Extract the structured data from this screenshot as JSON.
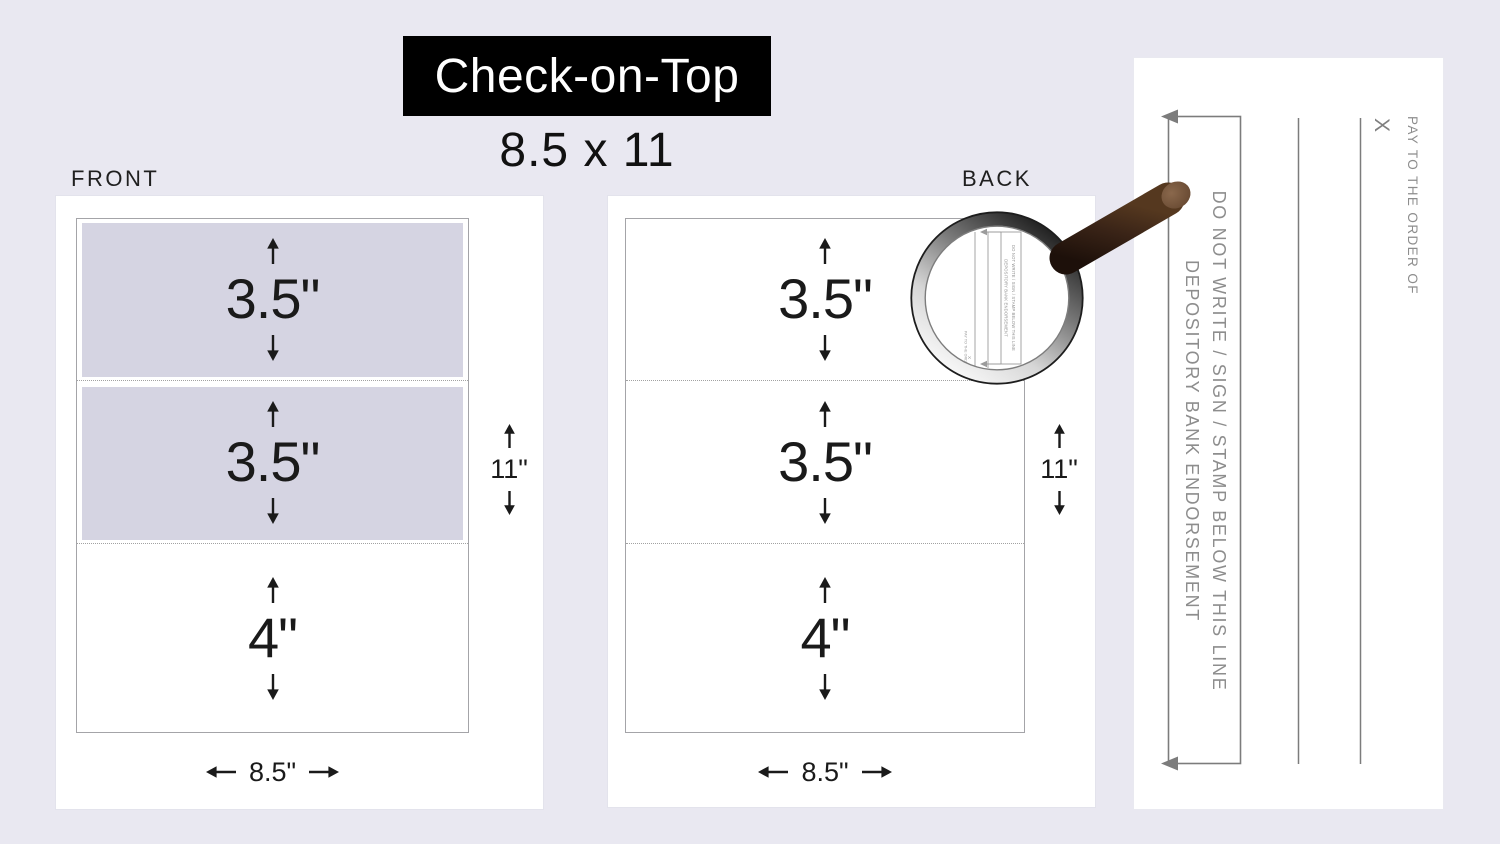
{
  "header": {
    "banner_title": "Check-on-Top",
    "sheet_size": "8.5 x 11"
  },
  "front_panel": {
    "label": "FRONT",
    "sections": [
      {
        "label": "3.5\"",
        "shaded": true
      },
      {
        "label": "3.5\"",
        "shaded": true
      },
      {
        "label": "4\"",
        "shaded": false
      }
    ],
    "height_label": "11\"",
    "width_label": "8.5\""
  },
  "back_panel": {
    "label": "BACK",
    "sections": [
      {
        "label": "3.5\"",
        "shaded": false
      },
      {
        "label": "3.5\"",
        "shaded": false
      },
      {
        "label": "4\"",
        "shaded": false
      }
    ],
    "height_label": "11\"",
    "width_label": "8.5\""
  },
  "endorsement_detail": {
    "warning_line1": "DO NOT WRITE / SIGN / STAMP BELOW THIS LINE",
    "warning_line2": "DEPOSITORY BANK ENDORSEMENT",
    "sign_x": "X",
    "pay_to": "PAY TO THE ORDER OF"
  },
  "magnifier_view": {
    "warning_line1": "DO NOT WRITE / SIGN / STAMP BELOW THIS LINE",
    "warning_line2": "DEPOSITORY BANK ENDORSEMENT",
    "pay_to": "PAY TO THE ORDER OF",
    "sign_x": "X"
  },
  "colors": {
    "page_background": "#e9e8f1",
    "banner_background": "#000000",
    "banner_text": "#ffffff",
    "check_shading": "#d5d4e2",
    "dimension_ink": "#1a1a1a",
    "endorsement_gray": "#8d8d8d",
    "page_border": "#a9a9a9",
    "magnifier_handle_brown": "#2f1c13"
  }
}
